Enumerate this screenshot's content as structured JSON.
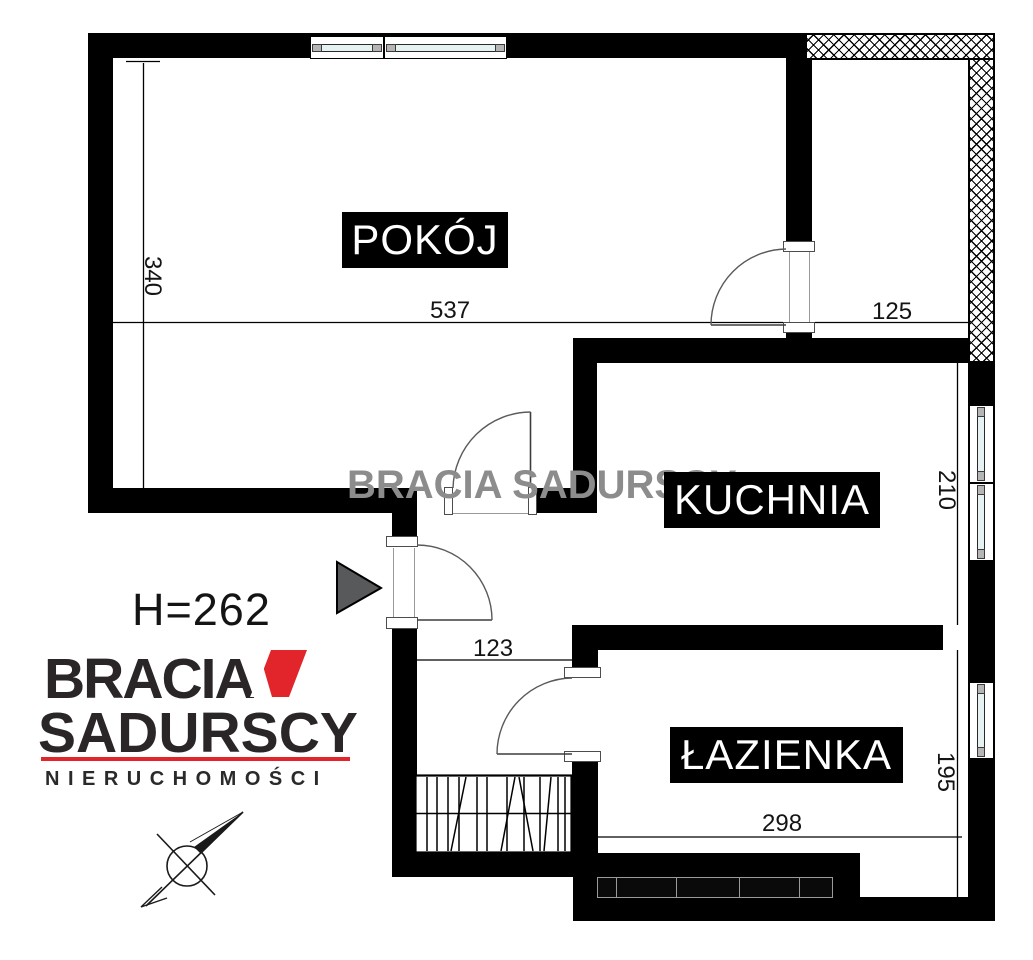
{
  "plan": {
    "rooms": [
      {
        "label": "POKÓJ"
      },
      {
        "label": "KUCHNIA"
      },
      {
        "label": "ŁAZIENKA"
      }
    ],
    "ceiling_height": "H=262",
    "dimensions": {
      "pokoj_vertical": "340",
      "pokoj_horizontal": "537",
      "balcony_width": "125",
      "kuchnia_vertical": "210",
      "hallway_width": "123",
      "lazienka_vertical": "195",
      "lazienka_horizontal": "298"
    }
  },
  "watermark_text": "BRACIA SADURSCY",
  "logo": {
    "brand_line1": "BRACIA",
    "brand_line2": "SADURSCY",
    "tagline": "NIERUCHOMOŚCI"
  },
  "icons": {
    "north_arrow": "compass-north-arrow",
    "entrance_arrow": "entrance-direction-triangle"
  },
  "colors": {
    "wall": "#000000",
    "brand_red": "#e2242b",
    "glass": "#e6f2f2",
    "frame_gray": "#b5b5b5",
    "watermark_gray": "#8c8c8c",
    "arrow_gray": "#58595b"
  }
}
